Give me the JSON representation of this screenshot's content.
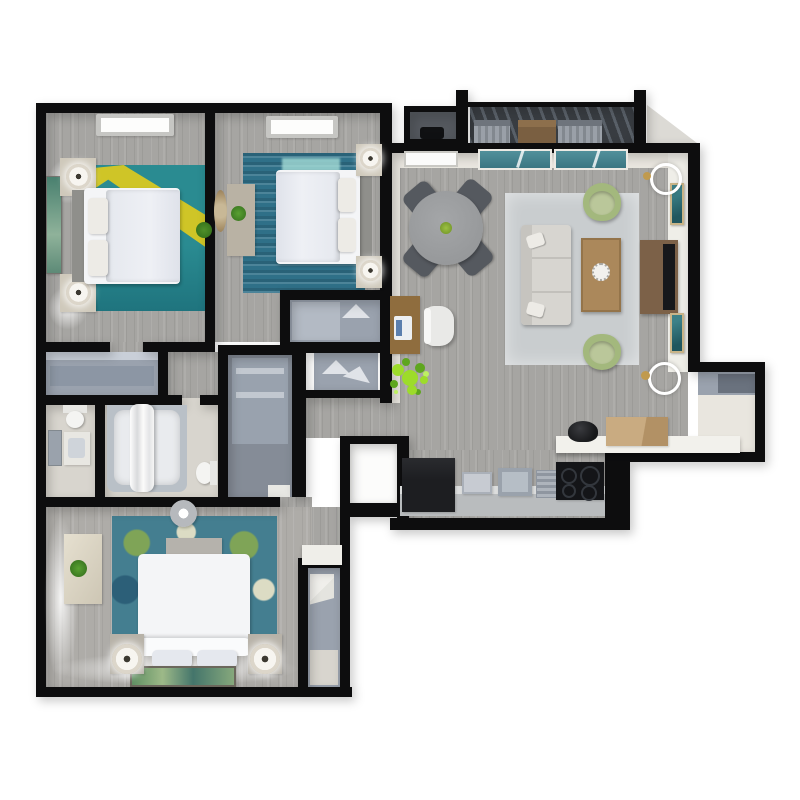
{
  "meta": {
    "title": "3D Apartment Floor Plan",
    "description": "Top-down 3D rendered floor plan of a two/three bedroom apartment with living-dining room, kitchen, two bathrooms, closets, balcony and a master suite.",
    "background": "#ffffff"
  },
  "colors": {
    "wall": "#0d0d0e",
    "wood": "#a6a5a2",
    "woodlight": "#aeaca8",
    "tile": "#d8d5ce",
    "cream": "#e9e6df",
    "closet": "#9aa2ae",
    "closetdark": "#8c96a4",
    "utility": "#858c97",
    "rugteal": "#2a8b91",
    "rugtealdark": "#1f747e",
    "rugyellow": "#d8c822",
    "rugblue": "#2f7088",
    "rugaqua": "#a4dcd6",
    "floral": "#447e90",
    "floralgreen": "#7fa457",
    "floralcream": "#dcdcc4",
    "rugliving": "#c9cdcf",
    "sofa": "#d7d5d0",
    "pillow": "#edebe6",
    "greenchair": "#a3b87d",
    "greenseat": "#bac79a",
    "greendark": "#859e5e",
    "woodtable": "#ab885b",
    "wooddesk": "#8f6d3e",
    "woodconsole": "#7c6148",
    "woodbox": "#c9ab81",
    "tv": "#17181b",
    "dtable": "#97999b",
    "dchair": "#55595f",
    "counterfront": "#b9bcbe",
    "countertop": "#dcdddd",
    "fridge": "#1d1e21",
    "stove": "#141518",
    "sink": "#9aa2ac",
    "glass": "#3b7682",
    "glasslight": "#52909b",
    "slat": "#383c41",
    "slatlight": "#596068",
    "lampwood": "#cfc9bb",
    "plant": "#5ea61e",
    "plantlight": "#9ddc2a",
    "gold": "#c09a4e",
    "headboard": "#8f8f8b",
    "duvet": "#e5e8ee",
    "bedwhite": "#f4f5f7",
    "gray": "#b6b9bd"
  },
  "rooms": {
    "bedroom1": {
      "label": "Bedroom 1",
      "furniture": [
        "queen-bed",
        "two-nightstands",
        "two-lamps",
        "wall-art",
        "teal-rug-with-sunlight",
        "ceiling-light",
        "plant"
      ]
    },
    "bedroom2": {
      "label": "Bedroom 2",
      "furniture": [
        "queen-bed",
        "two-nightstands",
        "two-lamps",
        "dresser",
        "round-woven-mirror",
        "blue-striped-rug",
        "ceiling-light",
        "plant",
        "reach-in-closet"
      ]
    },
    "living": {
      "label": "Living Room",
      "furniture": [
        "sofa",
        "coffee-table",
        "two-green-accent-chairs",
        "area-rug",
        "tv-console",
        "tv",
        "two-wall-arts",
        "two-round-sconces",
        "sliding-glass-door",
        "window",
        "desk",
        "laptop",
        "office-chair",
        "potted-plant"
      ]
    },
    "dining": {
      "label": "Dining Area",
      "furniture": [
        "round-table",
        "four-chairs",
        "green-centerpiece"
      ]
    },
    "kitchen": {
      "label": "Kitchen",
      "furniture": [
        "refrigerator",
        "counter",
        "sink",
        "dish-rack",
        "cooktop",
        "breakfast-bar",
        "black-bowl",
        "cardboard-box"
      ]
    },
    "bathroom": {
      "label": "Main Bathroom",
      "furniture": [
        "bathtub",
        "shower-curtain",
        "toilet"
      ]
    },
    "powder": {
      "label": "Second Bathroom",
      "furniture": [
        "toilet",
        "vanity-sink",
        "mirror"
      ]
    },
    "utility": {
      "label": "Utility Closet",
      "furniture": [
        "tall-cabinet",
        "shelves"
      ]
    },
    "hall": {
      "label": "Hallway",
      "furniture": [
        "linen-closet",
        "hall-closet"
      ]
    },
    "master": {
      "label": "Master Bedroom",
      "furniture": [
        "king-bed",
        "two-nightstands",
        "two-round-lamps",
        "foot-bench",
        "dresser",
        "plant",
        "floral-rug",
        "ceiling-fan",
        "wall-art"
      ]
    },
    "walk_in_closet": {
      "label": "Walk-in Closet",
      "furniture": [
        "shelving"
      ]
    },
    "laundry": {
      "label": "Laundry / Storage",
      "furniture": [
        "bright-lit-closet"
      ]
    },
    "entry_closet": {
      "label": "Entry Coat Closet",
      "furniture": [
        "shelf"
      ]
    },
    "balcony": {
      "label": "Balcony",
      "furniture": [
        "two-slat-chairs",
        "wood-table",
        "storage-closet",
        "pergola-deck"
      ]
    }
  }
}
